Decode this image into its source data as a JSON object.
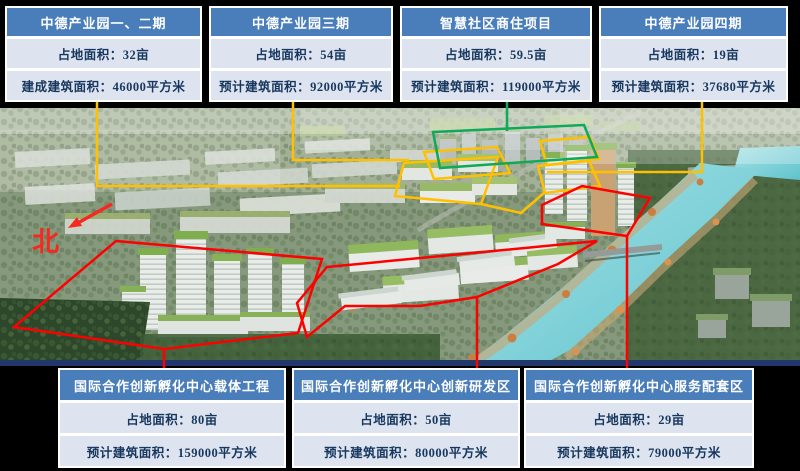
{
  "slide": {
    "background": "#000000"
  },
  "legend_colors": {
    "zone_yellow": "#FFC000",
    "zone_green": "#0FA958",
    "zone_red": "#FE0000",
    "box_header_blue": "#4A7EBB",
    "box_row_blue": "#DDE4F0",
    "box_text_navy": "#17375E"
  },
  "north_label": "北",
  "top_boxes": [
    {
      "title": "中德产业园一、二期",
      "rows": [
        "占地面积：32亩",
        "建成建筑面积：46000平方米"
      ]
    },
    {
      "title": "中德产业园三期",
      "rows": [
        "占地面积：54亩",
        "预计建筑面积：92000平方米"
      ]
    },
    {
      "title": "智慧社区商住项目",
      "rows": [
        "占地面积：59.5亩",
        "预计建筑面积：119000平方米"
      ]
    },
    {
      "title": "中德产业园四期",
      "rows": [
        "占地面积：19亩",
        "预计建筑面积：37680平方米"
      ]
    }
  ],
  "bottom_boxes": [
    {
      "title": "国际合作创新孵化中心载体工程",
      "rows": [
        "占地面积：80亩",
        "预计建筑面积：159000平方米"
      ]
    },
    {
      "title": "国际合作创新孵化中心创新研发区",
      "rows": [
        "占地面积：50亩",
        "预计建筑面积：80000平方米"
      ]
    },
    {
      "title": "国际合作创新孵化中心服务配套区",
      "rows": [
        "占地面积：29亩",
        "预计建筑面积：79000平方米"
      ]
    }
  ]
}
